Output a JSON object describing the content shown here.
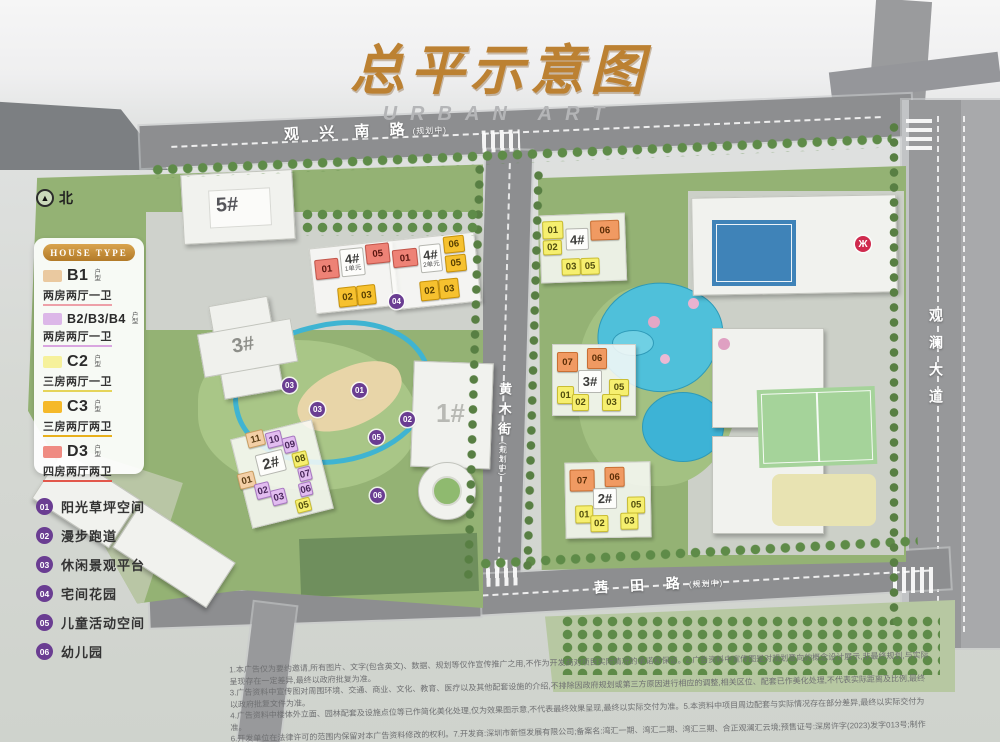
{
  "title": {
    "main": "总平示意图",
    "sub": "URBAN ART"
  },
  "north_label": "北",
  "legend": {
    "header": "HOUSE TYPE",
    "suffix": "户型",
    "items": [
      {
        "code": "B1",
        "desc": "两房两厅一卫",
        "color": "#eac9a0",
        "underline": "#eda0a8"
      },
      {
        "code": "B2/B3/B4",
        "desc": "两房两厅一卫",
        "color": "#dcb7e8",
        "underline": "#d9a6e0"
      },
      {
        "code": "C2",
        "desc": "三房两厅一卫",
        "color": "#f6f19b",
        "underline": "#e5d45a"
      },
      {
        "code": "C3",
        "desc": "三房两厅两卫",
        "color": "#f5b929",
        "underline": "#e8b01c"
      },
      {
        "code": "D3",
        "desc": "四房两厅两卫",
        "color": "#ef8b82",
        "underline": "#e2574b"
      }
    ]
  },
  "amenities": [
    {
      "num": "01",
      "label": "阳光草坪空间"
    },
    {
      "num": "02",
      "label": "漫步跑道"
    },
    {
      "num": "03",
      "label": "休闲景观平台"
    },
    {
      "num": "04",
      "label": "宅间花园"
    },
    {
      "num": "05",
      "label": "儿童活动空间"
    },
    {
      "num": "06",
      "label": "幼儿园"
    }
  ],
  "roads": {
    "top": {
      "name": "观 兴 南 路",
      "note": "(规划中)"
    },
    "middle": {
      "name": "黄木街",
      "note": "(规划中)"
    },
    "bottom": {
      "name": "茜 田 路",
      "note": "(规划中)"
    },
    "right": {
      "name": "观澜大道"
    }
  },
  "buildings": {
    "b5": "5#",
    "b3_left": "3#",
    "b1": "1#",
    "b2_left": "2#",
    "b4_u1": {
      "label": "4#",
      "unit": "1单元"
    },
    "b4_u2": {
      "label": "4#",
      "unit": "2单元"
    },
    "b4_right": "4#",
    "b3_right": "3#",
    "b2_right": "2#"
  },
  "blocks": {
    "l4u1": [
      {
        "n": "01"
      },
      {
        "n": "05"
      },
      {
        "n": "02"
      },
      {
        "n": "03"
      }
    ],
    "l4u2": [
      {
        "n": "01"
      },
      {
        "n": "06"
      },
      {
        "n": "05"
      },
      {
        "n": "02"
      },
      {
        "n": "03"
      }
    ],
    "l2": [
      {
        "n": "11"
      },
      {
        "n": "10"
      },
      {
        "n": "09"
      },
      {
        "n": "08"
      },
      {
        "n": "07"
      },
      {
        "n": "06"
      },
      {
        "n": "05"
      },
      {
        "n": "01"
      },
      {
        "n": "02"
      },
      {
        "n": "03"
      }
    ],
    "r4": [
      {
        "n": "01"
      },
      {
        "n": "02"
      },
      {
        "n": "06"
      },
      {
        "n": "03"
      },
      {
        "n": "05"
      }
    ],
    "r3": [
      {
        "n": "07"
      },
      {
        "n": "06"
      },
      {
        "n": "05"
      },
      {
        "n": "01"
      },
      {
        "n": "02"
      },
      {
        "n": "03"
      }
    ],
    "r2": [
      {
        "n": "07"
      },
      {
        "n": "06"
      },
      {
        "n": "05"
      },
      {
        "n": "01"
      },
      {
        "n": "02"
      },
      {
        "n": "03"
      }
    ]
  },
  "map_badges": [
    "04",
    "03",
    "01",
    "03",
    "02",
    "05",
    "06"
  ],
  "palette": {
    "title_gold": "#bc8132",
    "road_gray": "#8d8e90",
    "parcel_green": "#94b274",
    "water_blue": "#4fc0da",
    "badge_purple": "#6a3d92",
    "unit_red": "#ee8276",
    "unit_amber": "#f6c12f",
    "unit_yellow": "#f6ef6f",
    "unit_orange": "#f09a62",
    "unit_purple": "#e2bdf0",
    "unit_tan": "#f3cfa6",
    "metro_red": "#cf2b4e"
  },
  "disclaimer": {
    "lines": [
      "1.本广告仅为要约邀请,所有图片、文字(包含英文)、数据、规划等仅作宣传推广之用,不作为开发商对项目实际情况的承诺和保证。2.广告资料中宣传图是对规划意向的概念设计展示,非最终规划,与实际呈现存在一定差异,最终以政府批复为准。",
      "3.广告资料中宣传图对周围环境、交通、商业、文化、教育、医疗以及其他配套设施的介绍,不排除因政府规划或第三方原因进行相应的调整,相关区位、配套已作美化处理,不代表实际距离及比例,最终以政府批复文件为准。",
      "4.广告资料中楼体外立面、园林配套及设施点位等已作简化美化处理,仅为效果图示意,不代表最终效果呈现,最终以实际交付为准。5.本资料中项目周边配套与实际情况存在部分差异,最终以实际交付为准。",
      "6.开发单位在法律许可的范围内保留对本广告资料修改的权利。7.开发商:深圳市新恒发展有限公司;备案名:湾汇一期、湾汇二期、湾汇三期、合正观澜汇云境;预售证号:深房许字(2023)发字013号;制作时间:2024年8月。"
    ]
  }
}
